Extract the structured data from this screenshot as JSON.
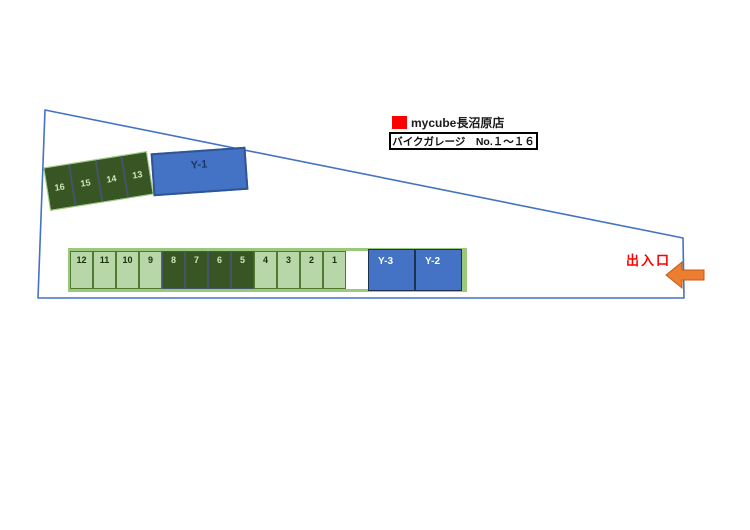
{
  "header": {
    "brand": "mycube長沼原店",
    "subtitle": "バイクガレージ　No.１～１６"
  },
  "entrance": {
    "label": "出入口"
  },
  "site": {
    "tilted_units": [
      "16",
      "15",
      "14",
      "13"
    ],
    "y_unit_top": "Y-1",
    "main_units": [
      "12",
      "11",
      "10",
      "9",
      "8",
      "7",
      "6",
      "5",
      "4",
      "3",
      "2",
      "1"
    ],
    "y_units_row": [
      "Y-3",
      "Y-2"
    ]
  },
  "colors": {
    "boundary_line": "#4472c4",
    "light_unit_fill": "#b7d7a8",
    "dark_unit_fill": "#375623",
    "strip_fill": "#9cc87e",
    "blue_unit_fill": "#4472c4",
    "accent_red": "#ff0000",
    "arrow_orange": "#ed7d31"
  }
}
